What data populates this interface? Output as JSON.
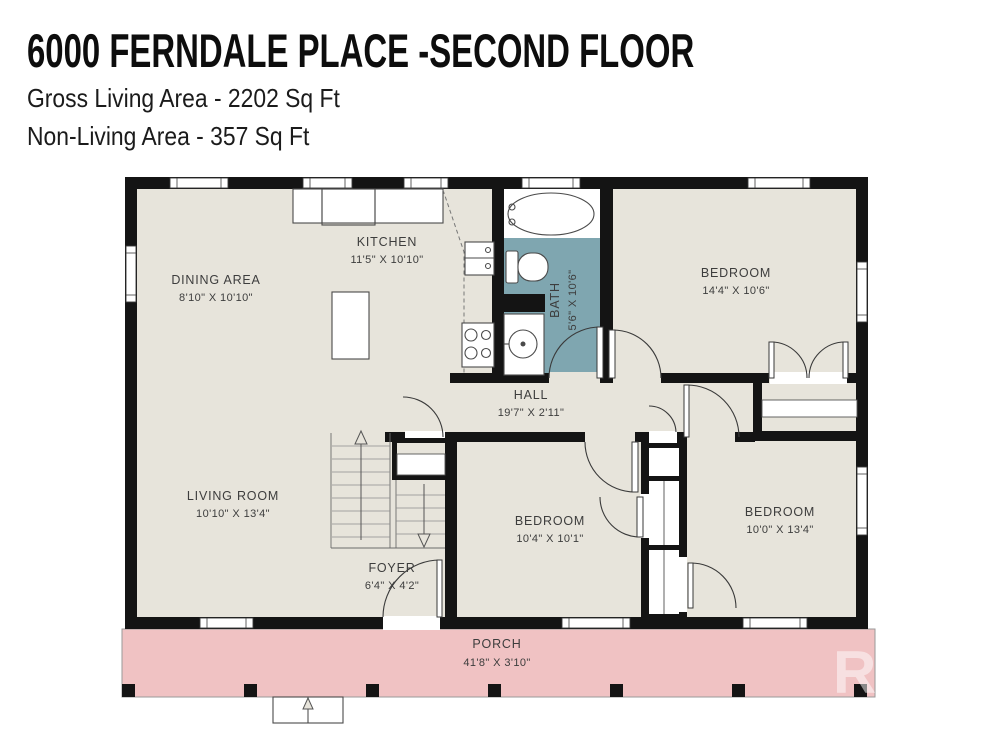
{
  "header": {
    "title": "6000 FERNDALE PLACE -SECOND FLOOR",
    "gross_living_area": "Gross Living Area - 2202 Sq Ft",
    "non_living_area": "Non-Living Area - 357 Sq Ft"
  },
  "rooms": {
    "dining": {
      "name": "DINING AREA",
      "dims": "8'10\" X 10'10\""
    },
    "kitchen": {
      "name": "KITCHEN",
      "dims": "11'5\" X 10'10\""
    },
    "bath": {
      "name": "BATH",
      "dims": "5'6\" X 10'6\""
    },
    "bedroom_top": {
      "name": "BEDROOM",
      "dims": "14'4\" X 10'6\""
    },
    "hall": {
      "name": "HALL",
      "dims": "19'7\" X 2'11\""
    },
    "living": {
      "name": "LIVING ROOM",
      "dims": "10'10\" X 13'4\""
    },
    "bedroom_middle": {
      "name": "BEDROOM",
      "dims": "10'4\" X 10'1\""
    },
    "bedroom_right": {
      "name": "BEDROOM",
      "dims": "10'0\" X 13'4\""
    },
    "foyer": {
      "name": "FOYER",
      "dims": "6'4\" X 4'2\""
    },
    "porch": {
      "name": "PORCH",
      "dims": "41'8\" X 3'10\""
    }
  },
  "watermark": "R",
  "colors": {
    "floor": "#e7e4db",
    "bath": "#7fa6b0",
    "porch": "#f0c2c3",
    "wall": "#141414"
  }
}
